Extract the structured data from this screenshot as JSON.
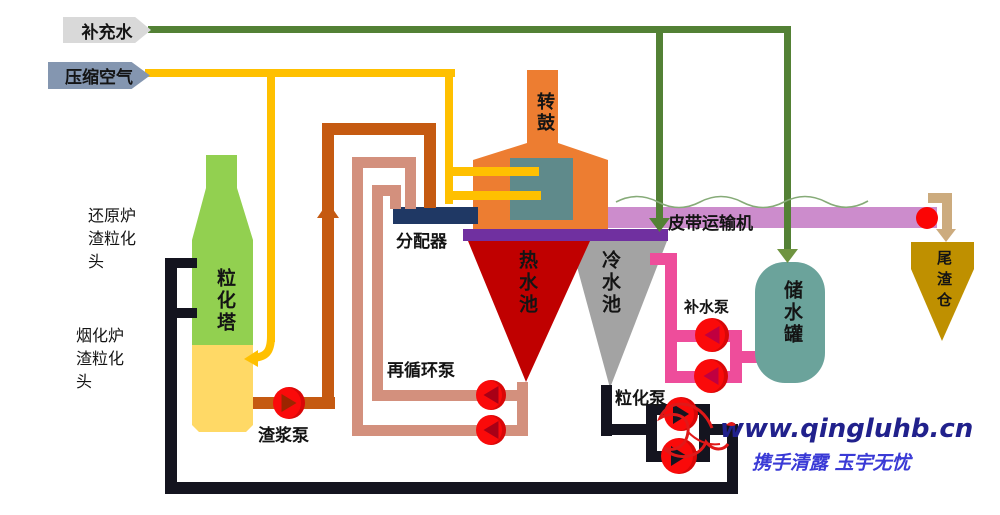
{
  "labels": {
    "makeup_water": "补充水",
    "compressed_air": "压缩空气",
    "rotary_drum": "转鼓",
    "distributor": "分配器",
    "hot_water_pool": "热水池",
    "cold_water_pool": "冷水池",
    "belt_conveyor": "皮带运输机",
    "tailings_bin": "尾渣仓",
    "water_makeup_pump": "补水泵",
    "storage_tank": "储水罐",
    "granulation_tower": "粒化塔",
    "reduction_furnace_head": "还原炉渣粒化头",
    "fuming_furnace_head": "烟化炉渣粒化头",
    "slurry_pump": "渣浆泵",
    "recirculation_pump": "再循环泵",
    "granulation_pump": "粒化泵"
  },
  "watermark": {
    "url": "www.qingluhb.cn",
    "slogan": "携手清露 玉宇无忧"
  },
  "colors": {
    "water_line_green": "#538135",
    "air_line_yellow": "#ffc000",
    "slurry_pipe_orange": "#c55a11",
    "hot_water_pipe_salmon": "#d3907d",
    "cold_water_pipe_black": "#14141f",
    "makeup_pipe_pink": "#ee4d9b",
    "tower_green": "#92d050",
    "tower_liquid_yellow": "#ffd966",
    "drum_orange": "#ed7d31",
    "drum_inner_teal": "#5f8a8b",
    "distributor_blue": "#1f3864",
    "collector_purple": "#7030a0",
    "hot_pool_red": "#c00000",
    "cold_pool_gray": "#a3a3a3",
    "belt_pink": "#cc8ccc",
    "tank_teal": "#6ba39b",
    "bin_gold": "#bf9000",
    "chute_tan": "#ccab7e",
    "pump_red": "#fa0a0a",
    "tag_gray": "#d9d9d9",
    "tag_bluegray": "#8496b0"
  }
}
